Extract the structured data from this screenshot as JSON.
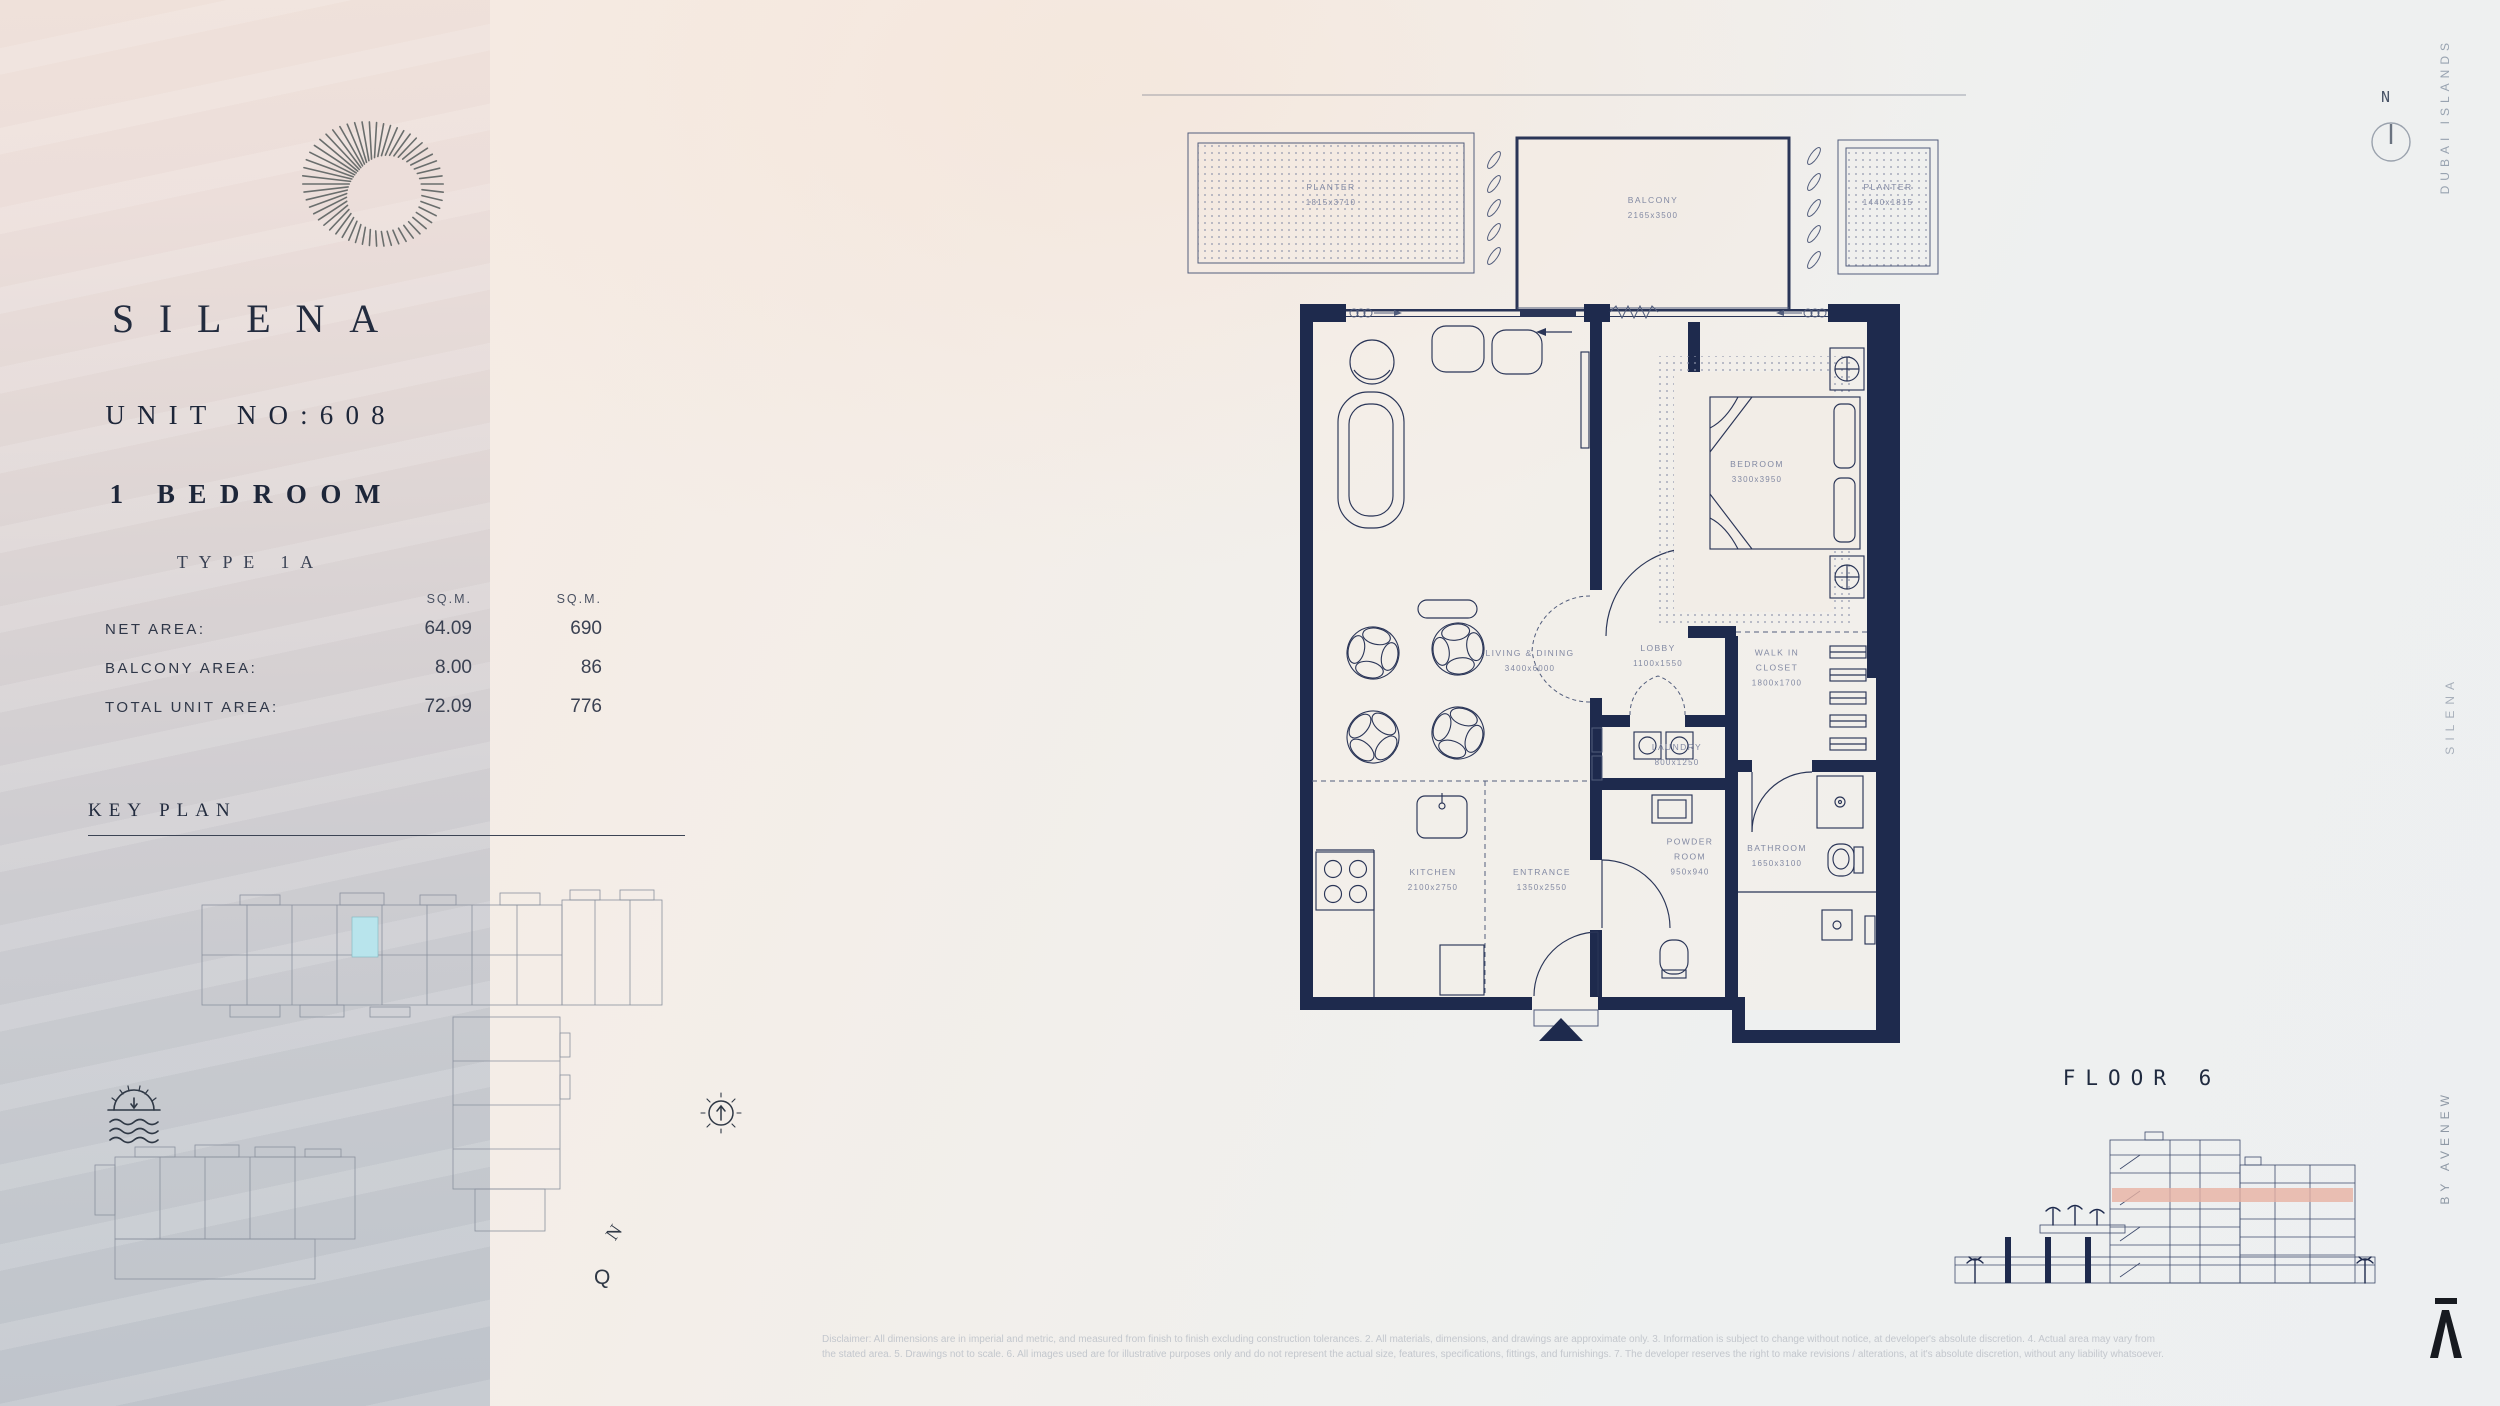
{
  "left_panel": {
    "brand": "SILENA",
    "unit_no": "UNIT NO:608",
    "bedroom": "1 BEDROOM",
    "type": "TYPE 1A",
    "area_table": {
      "headers": {
        "col1": "SQ.M.",
        "col2": "SQ.M."
      },
      "rows": [
        {
          "label": "NET AREA:",
          "v1": "64.09",
          "v2": "690"
        },
        {
          "label": "BALCONY AREA:",
          "v1": "8.00",
          "v2": "86"
        },
        {
          "label": "TOTAL UNIT AREA:",
          "v1": "72.09",
          "v2": "776"
        }
      ]
    },
    "key_plan_title": "KEY PLAN",
    "keyplan_compass_n": "N",
    "keyplan_compass_q": "Q"
  },
  "floor_plan": {
    "outdoor": [
      {
        "lines": [
          "PLANTER"
        ],
        "dims": "1815x3710"
      },
      {
        "lines": [
          "BALCONY"
        ],
        "dims": "2165x3500"
      },
      {
        "lines": [
          "PLANTER"
        ],
        "dims": "1440x1815"
      }
    ],
    "rooms": [
      {
        "lines": [
          "LIVING & DINING"
        ],
        "dims": "3400x6000"
      },
      {
        "lines": [
          "BEDROOM"
        ],
        "dims": "3300x3950"
      },
      {
        "lines": [
          "LOBBY"
        ],
        "dims": "1100x1550"
      },
      {
        "lines": [
          "WALK IN",
          "CLOSET"
        ],
        "dims": "1800x1700"
      },
      {
        "lines": [
          "LAUNDRY"
        ],
        "dims": "800x1250"
      },
      {
        "lines": [
          "KITCHEN"
        ],
        "dims": "2100x2750"
      },
      {
        "lines": [
          "ENTRANCE"
        ],
        "dims": "1350x2550"
      },
      {
        "lines": [
          "POWDER",
          "ROOM"
        ],
        "dims": "950x940"
      },
      {
        "lines": [
          "BATHROOM"
        ],
        "dims": "1650x3100"
      }
    ]
  },
  "right_panel": {
    "floor_label": "FLOOR 6",
    "compass_label": "N",
    "edge_top": "DUBAI ISLANDS",
    "edge_middle": "SILENA",
    "edge_bottom": "BY AVENEW"
  },
  "disclaimer": {
    "line1": "Disclaimer: All dimensions are in imperial and metric, and measured from finish to finish excluding construction tolerances. 2. All materials, dimensions, and drawings are approximate only. 3. Information is subject to change without notice, at developer's absolute discretion. 4. Actual area may vary from",
    "line2": "the stated area. 5. Drawings not to scale. 6. All images used are for illustrative purposes only and do not represent the actual size, features, specifications, fittings, and furnishings. 7. The developer reserves the right to make revisions / alterations, at it's absolute discretion, without any liability whatsoever."
  },
  "colors": {
    "wall": "#1e2a4d",
    "keyplan_highlight": "#b8e4ec",
    "floor_band": "#e7b2a3"
  }
}
